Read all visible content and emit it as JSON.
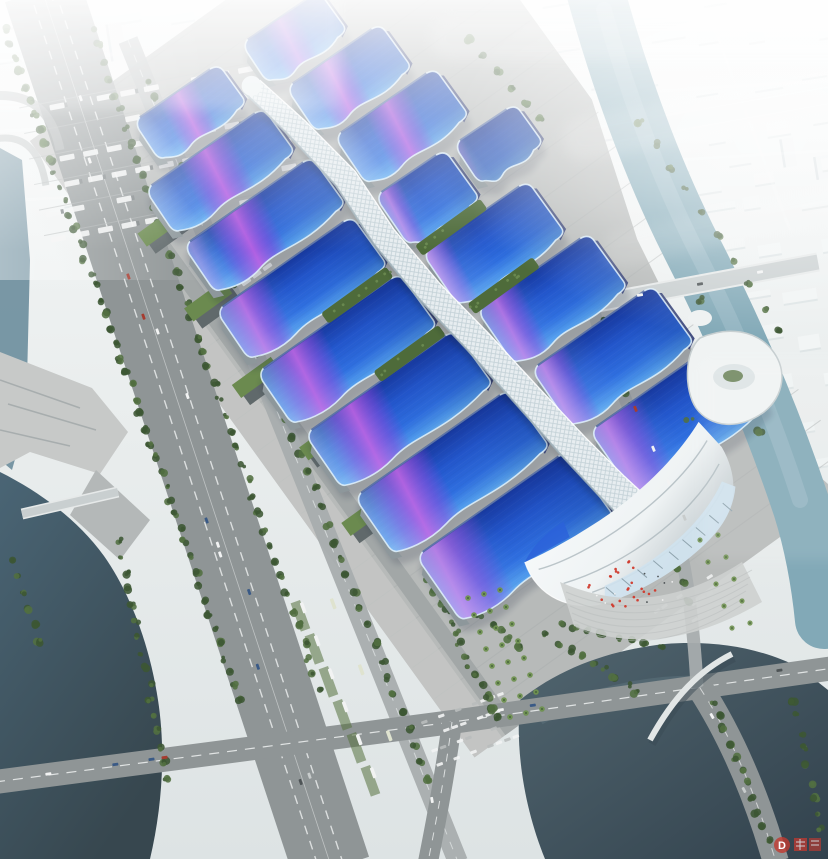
{
  "scene": {
    "type": "architectural-aerial-rendering",
    "description": "Bird's-eye rendering of a huge exhibition and convention center: paired halls with wavy blue roofs crossed by purple ribbon patterns, a white serpentine central corridor, a shell-shaped south entrance hall, surrounded by highways, canals, a lake, parking lots, trees and a fog-shrouded white city.",
    "watermark": {
      "letter": "D"
    }
  },
  "illustration": {
    "hall_rows": 8,
    "halls_have_ribbons": true,
    "spine": "central-serpentine-corridor",
    "landmarks": [
      "south-entrance-shell",
      "riverside-landmark-building",
      "arched-foot-bridge",
      "road-bridge-over-river"
    ]
  },
  "palette": {
    "fogTop": "#f6f8f8",
    "fogBottom": "#dde3e4",
    "city": "#f3f6f6",
    "cityShade": "#ccd5d8",
    "riverTeal": "#82a9b7",
    "riverLight": "#a9c6cf",
    "canalDark": "#4a6575",
    "canalDeep": "#37474f",
    "lakeNavy": "#3a4d5a",
    "lakeMid": "#51656f",
    "road": "#8f9596",
    "roadLight": "#a8adae",
    "lane": "#eff1f1",
    "bridge": "#c9cfd0",
    "site": "#b7bab9",
    "siteLight": "#c7c9c8",
    "apron": "#a2a7a7",
    "plaza": "#cfd2d0",
    "treeDark": "#3c5733",
    "treeMid": "#527041",
    "treeLight": "#6d8c52",
    "grass": "#56713e",
    "palm": "#6f9150",
    "shedGreen": "#6b8a4f",
    "shedWall": "#60696b",
    "roofDeep": "#17389e",
    "roofMid": "#2357cd",
    "roofBright": "#2f6fe0",
    "roofLight": "#4f9aec",
    "roofPale": "#6cb4f2",
    "ribbon": "#8a43dc",
    "ribbonHot": "#c257e2",
    "spine": "#e7edf0",
    "spineLine": "#c2d0d6",
    "spineShade": "#9fb0b8",
    "shellWhite": "#eff3f4",
    "shellShade": "#c0c9cd",
    "glass": "#cfe2ee",
    "trim": "#e2f3fd",
    "navyWall": "#27346f",
    "flag": "#d03a2c",
    "carWhite": "#f2f3f3",
    "carDark": "#4e5456",
    "watermark": "#c23a30"
  }
}
